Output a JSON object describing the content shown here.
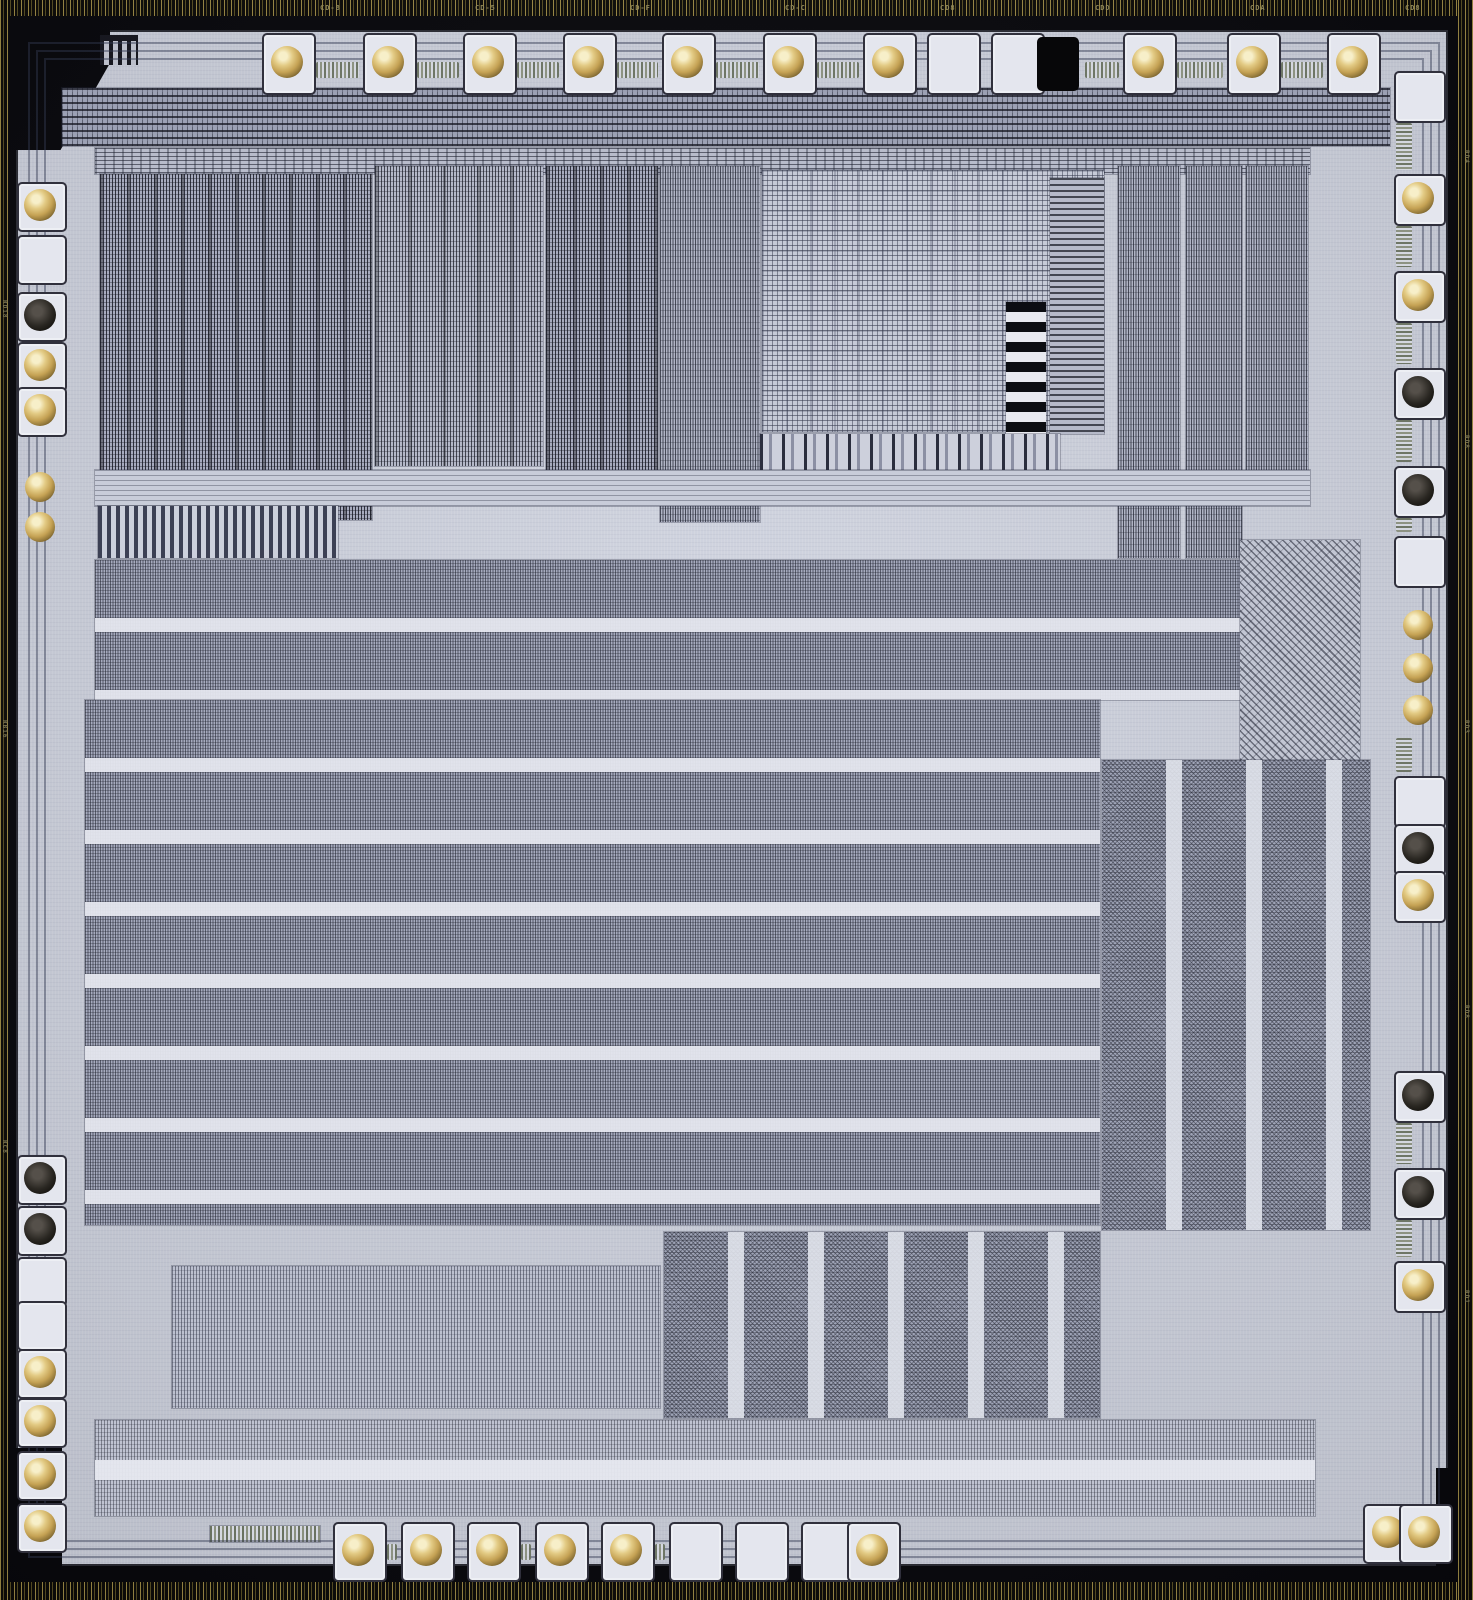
{
  "image": {
    "type": "die-photograph",
    "subject": "Integrated circuit silicon die, top-down microscope photograph with gold wire-bond balls on perimeter pads",
    "die_label": "U8001"
  },
  "palette": {
    "frame_black": "#07070b",
    "scribe_gold": "#9d8a45",
    "die_surface": "#ced2de",
    "routing_channel": "#e2e4ec",
    "dense_logic": "#a5aabd",
    "trace_dark": "#1c1e2c",
    "pad_white": "#e4e6ee",
    "ball_gold": "#d9b96a",
    "ball_dark": "#2a2722"
  },
  "scribe_marks_top": [
    "CD-8",
    "CD-5",
    "CD-F",
    "CD-C",
    "CD8",
    "CDD",
    "CDA",
    "CD8"
  ],
  "scribe_marks_left": [
    "RD18",
    "RB16",
    "RC8"
  ],
  "scribe_marks_right": [
    "RD4",
    "RD8",
    "RD3",
    "RD8",
    "RD1"
  ],
  "rings": [
    12,
    20,
    28
  ],
  "pads": {
    "top": [
      {
        "x": 287,
        "ball": "gold"
      },
      {
        "x": 388,
        "ball": "gold"
      },
      {
        "x": 488,
        "ball": "gold"
      },
      {
        "x": 588,
        "ball": "gold"
      },
      {
        "x": 687,
        "ball": "gold"
      },
      {
        "x": 788,
        "ball": "gold"
      },
      {
        "x": 888,
        "ball": "gold"
      },
      {
        "x": 952,
        "ball": "none"
      },
      {
        "x": 1016,
        "ball": "none"
      },
      {
        "x": 1056,
        "ball": "void"
      },
      {
        "x": 1148,
        "ball": "gold"
      },
      {
        "x": 1252,
        "ball": "gold"
      },
      {
        "x": 1352,
        "ball": "gold"
      }
    ],
    "bottom": [
      {
        "x": 358,
        "ball": "gold"
      },
      {
        "x": 426,
        "ball": "gold"
      },
      {
        "x": 492,
        "ball": "gold"
      },
      {
        "x": 560,
        "ball": "gold"
      },
      {
        "x": 626,
        "ball": "gold"
      },
      {
        "x": 694,
        "ball": "none"
      },
      {
        "x": 760,
        "ball": "none"
      },
      {
        "x": 826,
        "ball": "none"
      },
      {
        "x": 872,
        "ball": "gold"
      },
      {
        "x": 1388,
        "y": 1532,
        "ball": "gold"
      },
      {
        "x": 1424,
        "y": 1532,
        "ball": "gold"
      }
    ],
    "left": [
      {
        "y": 205,
        "ball": "gold"
      },
      {
        "y": 258,
        "ball": "none"
      },
      {
        "y": 315,
        "ball": "dark"
      },
      {
        "y": 365,
        "ball": "gold"
      },
      {
        "y": 410,
        "ball": "gold"
      },
      {
        "y": 487,
        "ball": "bare"
      },
      {
        "y": 527,
        "ball": "bare"
      },
      {
        "y": 1178,
        "ball": "dark"
      },
      {
        "y": 1229,
        "ball": "dark"
      },
      {
        "y": 1280,
        "ball": "none"
      },
      {
        "y": 1324,
        "ball": "none"
      },
      {
        "y": 1372,
        "ball": "gold"
      },
      {
        "y": 1421,
        "ball": "gold"
      },
      {
        "y": 1474,
        "ball": "gold"
      },
      {
        "y": 1526,
        "ball": "gold"
      }
    ],
    "right": [
      {
        "y": 95,
        "ball": "none"
      },
      {
        "y": 198,
        "ball": "gold"
      },
      {
        "y": 295,
        "ball": "gold"
      },
      {
        "y": 392,
        "ball": "dark"
      },
      {
        "y": 490,
        "ball": "dark"
      },
      {
        "y": 560,
        "ball": "none"
      },
      {
        "y": 625,
        "ball": "bare"
      },
      {
        "y": 668,
        "ball": "bare"
      },
      {
        "y": 710,
        "ball": "bare"
      },
      {
        "y": 800,
        "ball": "none"
      },
      {
        "y": 848,
        "ball": "dark"
      },
      {
        "y": 895,
        "ball": "gold"
      },
      {
        "y": 1095,
        "ball": "dark"
      },
      {
        "y": 1192,
        "ball": "dark"
      },
      {
        "y": 1285,
        "ball": "gold"
      }
    ]
  },
  "blocks": [
    {
      "name": "top-bus-band",
      "x": 62,
      "y": 88,
      "w": 1328,
      "h": 58,
      "tex": "hstripesDense"
    },
    {
      "name": "top-bus-band-2",
      "x": 95,
      "y": 148,
      "w": 1215,
      "h": 26,
      "tex": "hstripesFine"
    },
    {
      "name": "logic-upper-left",
      "x": 100,
      "y": 174,
      "w": 272,
      "h": 346,
      "tex": "vnoise"
    },
    {
      "name": "logic-upper-mid-a",
      "x": 375,
      "y": 166,
      "w": 168,
      "h": 300,
      "tex": "vnoise2"
    },
    {
      "name": "logic-upper-mid-b",
      "x": 546,
      "y": 166,
      "w": 112,
      "h": 332,
      "tex": "vnoise"
    },
    {
      "name": "column-decoder",
      "x": 660,
      "y": 166,
      "w": 100,
      "h": 356,
      "tex": "vfine"
    },
    {
      "name": "rom-array",
      "x": 762,
      "y": 170,
      "w": 342,
      "h": 262,
      "tex": "grid"
    },
    {
      "name": "rom-bitcell-column",
      "x": 1006,
      "y": 302,
      "w": 40,
      "h": 132,
      "tex": "bitsq"
    },
    {
      "name": "rom-driver-column",
      "x": 1050,
      "y": 178,
      "w": 54,
      "h": 256,
      "tex": "hfine"
    },
    {
      "name": "right-column-block-a",
      "x": 1118,
      "y": 166,
      "w": 62,
      "h": 392,
      "tex": "vfine"
    },
    {
      "name": "right-column-block-b",
      "x": 1186,
      "y": 166,
      "w": 56,
      "h": 392,
      "tex": "vfine"
    },
    {
      "name": "right-column-block-c",
      "x": 1246,
      "y": 166,
      "w": 62,
      "h": 330,
      "tex": "vfine"
    },
    {
      "name": "rom-output-row",
      "x": 760,
      "y": 434,
      "w": 300,
      "h": 38,
      "tex": "cellrow"
    },
    {
      "name": "mid-routing-band",
      "x": 95,
      "y": 470,
      "w": 1215,
      "h": 36,
      "tex": "hfineLight"
    },
    {
      "name": "comb-structures",
      "x": 98,
      "y": 506,
      "w": 240,
      "h": 52,
      "tex": "comb"
    },
    {
      "name": "mid-logic-band",
      "x": 95,
      "y": 560,
      "w": 1215,
      "h": 140,
      "tex": "hrows"
    },
    {
      "name": "diagonal-fanout",
      "x": 1240,
      "y": 540,
      "w": 120,
      "h": 220,
      "tex": "diag"
    },
    {
      "name": "main-logic-area",
      "x": 85,
      "y": 700,
      "w": 1015,
      "h": 525,
      "tex": "hrows"
    },
    {
      "name": "right-logic-area",
      "x": 1102,
      "y": 760,
      "w": 268,
      "h": 470,
      "tex": "noise"
    },
    {
      "name": "bottom-left-array",
      "x": 172,
      "y": 1266,
      "w": 488,
      "h": 142,
      "tex": "vfineLight"
    },
    {
      "name": "bottom-mid-logic",
      "x": 664,
      "y": 1232,
      "w": 436,
      "h": 186,
      "tex": "noise"
    },
    {
      "name": "bottom-bus-band",
      "x": 95,
      "y": 1420,
      "w": 1220,
      "h": 96,
      "tex": "hrows2"
    },
    {
      "name": "bottom-serpentine",
      "x": 210,
      "y": 1526,
      "w": 110,
      "h": 16,
      "tex": "serp"
    }
  ]
}
